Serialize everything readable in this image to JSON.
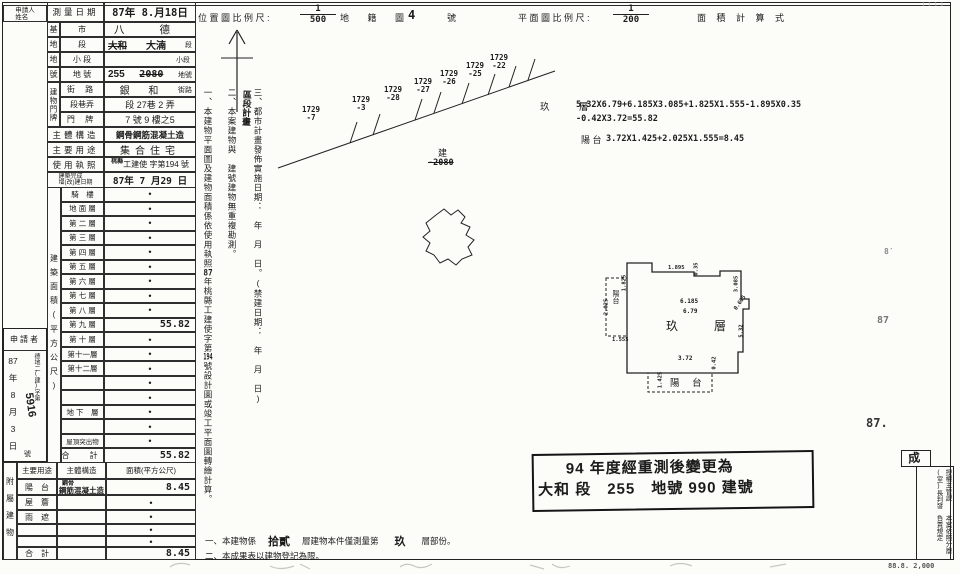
{
  "sheet": {
    "applicant_name_box": "申請人\n姓名",
    "survey": {
      "label": "測量日期",
      "value": "87年 8.月18日"
    },
    "site": {
      "c1": [
        "基",
        "地",
        "地",
        "號"
      ],
      "city": {
        "label": "市",
        "value": "八 德"
      },
      "section": {
        "label": "段",
        "old": "大和",
        "new": "大湳",
        "suffix": "段"
      },
      "subsection": {
        "label": "小 段",
        "suffix": "小段"
      },
      "lot": {
        "label": "地 號",
        "new": "255",
        "old": "2080",
        "suffix": "地號"
      }
    },
    "address": {
      "group": "建物門牌",
      "street": {
        "label": "街 路",
        "value": "銀 和",
        "suffix": "街路"
      },
      "lane": {
        "label": "段巷弄",
        "value": "段 27巷 2 弄"
      },
      "door": {
        "label": "門 牌",
        "value": "7 號 9 樓之5"
      }
    },
    "building": {
      "structure": {
        "label": "主體構造",
        "value": "鋼骨鋼筋混凝土造"
      },
      "use": {
        "label": "主要用途",
        "value": "集合住宅"
      },
      "license": {
        "label": "使用執照",
        "sup": "桃縣",
        "value": "工建使 字第194 號"
      },
      "completion": {
        "label": "建築完成\n增(改)建日期",
        "value": "87年 7 月29 日"
      }
    },
    "floors": {
      "side_label": "建築面積(平方公尺)",
      "rows": [
        {
          "l": "騎　樓",
          "v": "•"
        },
        {
          "l": "地 面 層",
          "v": "•"
        },
        {
          "l": "第 二 層",
          "v": "•"
        },
        {
          "l": "第 三 層",
          "v": "•"
        },
        {
          "l": "第 四 層",
          "v": "•"
        },
        {
          "l": "第 五 層",
          "v": "•"
        },
        {
          "l": "第 六 層",
          "v": "•"
        },
        {
          "l": "第 七 層",
          "v": "•"
        },
        {
          "l": "第 八 層",
          "v": "•"
        },
        {
          "l": "第 九 層",
          "v": "55.82"
        },
        {
          "l": "第 十 層",
          "v": "•"
        },
        {
          "l": "第十一層",
          "v": "•"
        },
        {
          "l": "第十二層",
          "v": "•"
        },
        {
          "l": "",
          "v": "•"
        },
        {
          "l": "",
          "v": "•"
        },
        {
          "l": "地 下　層",
          "v": "•"
        },
        {
          "l": "",
          "v": "•"
        },
        {
          "l": "屋頂突出物",
          "v": "•"
        },
        {
          "l": "合　計",
          "v": "55.82"
        }
      ]
    },
    "applicant_box": {
      "title": "申請者",
      "date": "87\n年\n8\n月\n3\n日",
      "doc_prefix": "德地二(建)字第",
      "doc_no": "5916",
      "doc_suffix": "號"
    },
    "attached": {
      "side_label": "附屬建物",
      "headers": {
        "use": "主要用途",
        "structure": "主體構造",
        "area": "面積(平方公尺)"
      },
      "rows": [
        {
          "use": "陽　台",
          "structure_sup": "鋼骨",
          "structure": "鋼筋混凝土造",
          "area": "8.45"
        },
        {
          "use": "屋　簷",
          "structure": "",
          "area": "•"
        },
        {
          "use": "雨　遮",
          "structure": "",
          "area": "•"
        },
        {
          "use": "",
          "structure": "",
          "area": "•"
        },
        {
          "use": "",
          "structure": "",
          "area": "•"
        },
        {
          "use": "合　計",
          "structure": "",
          "area": "8.45"
        }
      ]
    }
  },
  "side_notes": {
    "n1a": "一、本建物平面圖及建物面積係依使用執照",
    "n1b": "87",
    "n1c": "年桃縣工建使字第",
    "n1d": "194",
    "n1e": "號設計圖或竣工平面圖轉繪計算。",
    "n2": "二、本案建物與　建號建物無重複勘測。",
    "n3": "三、都市計畫發佈實施日期：　年　月　日。(禁建日期：　年　月　日)",
    "n3hw": "區段計畫"
  },
  "map_header": {
    "loc_label": "位 置 圖 比 例 尺 :",
    "loc_num": "1",
    "loc_den": "500",
    "cad_label": "地 籍 圖",
    "sheet_no": "4",
    "sheet_unit": "號",
    "plan_label": "平 面 圖 比 例 尺 :",
    "plan_num": "1",
    "plan_den": "200",
    "calc_label": "面 積 計 算 式"
  },
  "calc": {
    "f_label": "玖　層",
    "f1": "5.32X6.79+6.185X3.085+1.825X1.555-1.895X0.35",
    "f2": "-0.42X3.72=55.82",
    "b_label": "陽 台",
    "b1": "3.72X1.425+2.025X1.555=8.45"
  },
  "cadastral": {
    "lots": [
      "1729\n-7",
      "1729\n-3",
      "1729\n-28",
      "1729\n-27",
      "1729\n-26",
      "1729\n-25",
      "1729\n-22"
    ],
    "bldg": "建",
    "bldg_no": "-2080"
  },
  "plan": {
    "room": "玖　層",
    "balcony_b": "陽 台",
    "balcony_l": "陽台",
    "d_top": "1.895",
    "d_notch": "0.35",
    "d_rt": "3.085",
    "d_step": "0.605",
    "d_right": "5.32",
    "d_bottom": "3.72",
    "d_br": "0.42",
    "d_bl": "1.425",
    "d_lt": "1.825",
    "d_left": "2.025",
    "d_lb": "1.555",
    "d_w1": "6.185",
    "d_w2": "6.79"
  },
  "stamps": {
    "s1": "8′",
    "s2": "87",
    "s3": "87."
  },
  "change_note": {
    "l1": "94  年度經重測後變更為",
    "l2": "大和 段　255　地號 990 建號"
  },
  "bottom_notes": {
    "a1": "一、本建物係",
    "a2": "拾貳",
    "a3": "層建物本件僅測量第",
    "a4": "玖",
    "a5": "層部份。",
    "b": "二、本成果表以建物登記為限。"
  },
  "right_stamp": {
    "r": "授權主管課(室)長判發",
    "l": "本案依照分層負責規定",
    "mark": "成"
  },
  "misc": {
    "print": "88.8. 2,000",
    "corner": "1 1 1 1"
  }
}
